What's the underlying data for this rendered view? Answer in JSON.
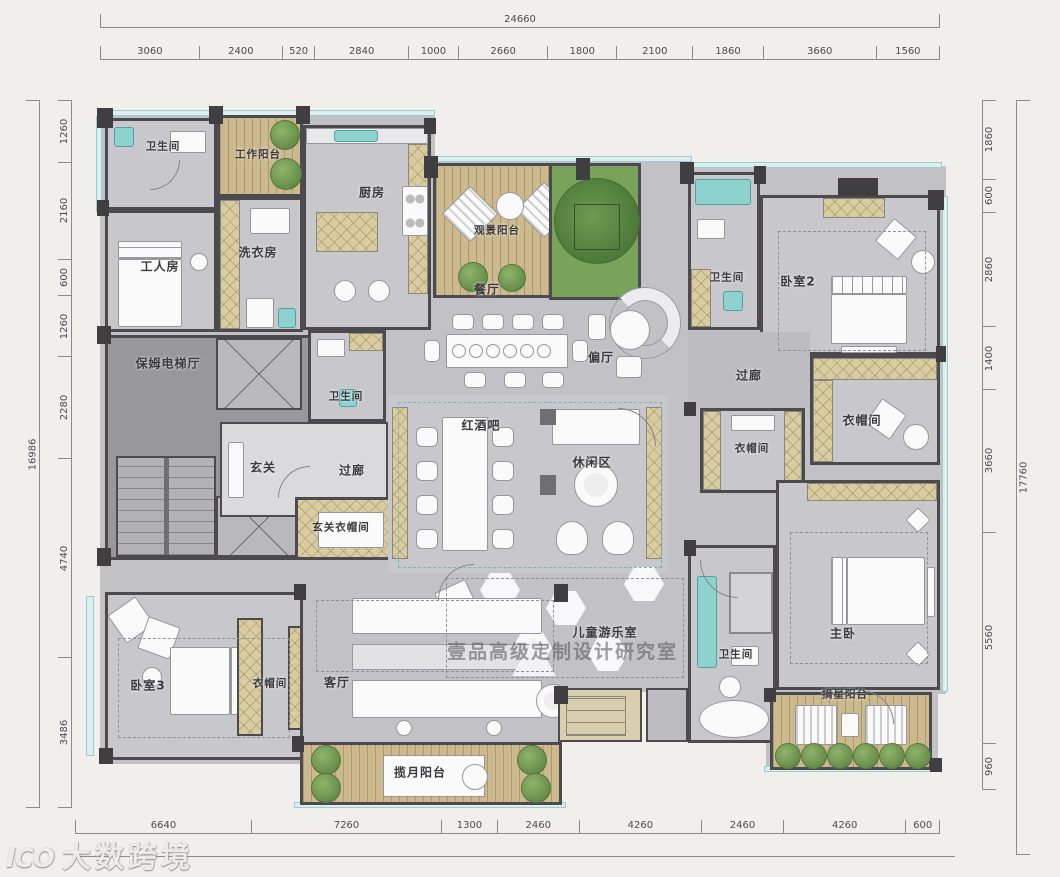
{
  "watermarks": {
    "studio": "壹品高级定制设计研究室",
    "brand": "大数跨境",
    "brand_logo": "ICO"
  },
  "dimensions": {
    "top_total": "24660",
    "top": [
      "3060",
      "2400",
      "520",
      "2840",
      "1000",
      "2660",
      "1800",
      "2100",
      "1860",
      "3660",
      "1560"
    ],
    "left_total": "16986",
    "left": [
      "1260",
      "2160",
      "600",
      "1260",
      "2280",
      "4740",
      "3486"
    ],
    "right_total": "17760",
    "right": [
      "1860",
      "600",
      "2860",
      "1400",
      "3660",
      "5560",
      "960"
    ],
    "bottom": [
      "6640",
      "7260",
      "1300",
      "2460",
      "4260",
      "2460",
      "4260",
      "600"
    ]
  },
  "rooms": [
    {
      "id": "bathroom-top-left",
      "label": "卫生间"
    },
    {
      "id": "work-balcony",
      "label": "工作阳台"
    },
    {
      "id": "kitchen",
      "label": "厨房"
    },
    {
      "id": "worker-room",
      "label": "工人房"
    },
    {
      "id": "laundry-room",
      "label": "洗衣房"
    },
    {
      "id": "view-balcony",
      "label": "观景阳台"
    },
    {
      "id": "dining-room",
      "label": "餐厅"
    },
    {
      "id": "side-hall",
      "label": "偏厅"
    },
    {
      "id": "bathroom-bedroom2",
      "label": "卫生间"
    },
    {
      "id": "bedroom-2",
      "label": "卧室2"
    },
    {
      "id": "nanny-elevator-hall",
      "label": "保姆电梯厅"
    },
    {
      "id": "bathroom-foyer",
      "label": "卫生间"
    },
    {
      "id": "foyer",
      "label": "玄关"
    },
    {
      "id": "corridor-foyer",
      "label": "过廊"
    },
    {
      "id": "foyer-cloakroom",
      "label": "玄关衣帽间"
    },
    {
      "id": "wine-bar",
      "label": "红酒吧"
    },
    {
      "id": "leisure-area",
      "label": "休闲区"
    },
    {
      "id": "corridor-right",
      "label": "过廊"
    },
    {
      "id": "cloakroom-master",
      "label": "衣帽间"
    },
    {
      "id": "cloakroom-middle",
      "label": "衣帽间"
    },
    {
      "id": "children-playroom",
      "label": "儿童游乐室"
    },
    {
      "id": "bedroom-3",
      "label": "卧室3"
    },
    {
      "id": "cloakroom-bedroom3",
      "label": "衣帽间"
    },
    {
      "id": "living-room",
      "label": "客厅"
    },
    {
      "id": "moon-balcony",
      "label": "揽月阳台"
    },
    {
      "id": "bathroom-master",
      "label": "卫生间"
    },
    {
      "id": "master-bedroom",
      "label": "主卧"
    },
    {
      "id": "star-balcony",
      "label": "摘星阳台"
    }
  ]
}
